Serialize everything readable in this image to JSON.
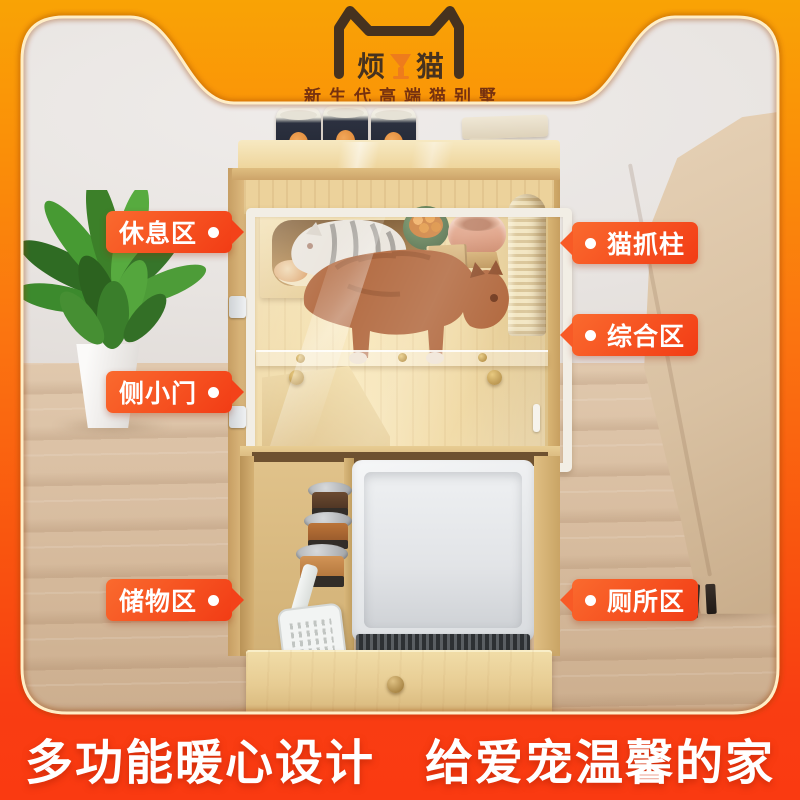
{
  "brand": {
    "left": "烦",
    "right": "猫",
    "tagline": "新生代高端猫别墅"
  },
  "callouts": {
    "left": [
      {
        "label": "休息区"
      },
      {
        "label": "侧小门"
      },
      {
        "label": "储物区"
      }
    ],
    "right": [
      {
        "label": "猫抓柱"
      },
      {
        "label": "综合区"
      },
      {
        "label": "厕所区"
      }
    ]
  },
  "footer": {
    "slogan": "多功能暖心设计　给爱宠温馨的家"
  },
  "theme": {
    "bg_gradient_top": "#f9a305",
    "bg_gradient_bottom": "#fa3a11",
    "callout_color": "#f3421a",
    "logo_ink": "#46321f",
    "tagline_ink": "#76310f",
    "slogan_ink": "#ffffff",
    "wood": "#ecd29b",
    "wall": "#e8e4e1",
    "floor": "#d8bda0"
  }
}
